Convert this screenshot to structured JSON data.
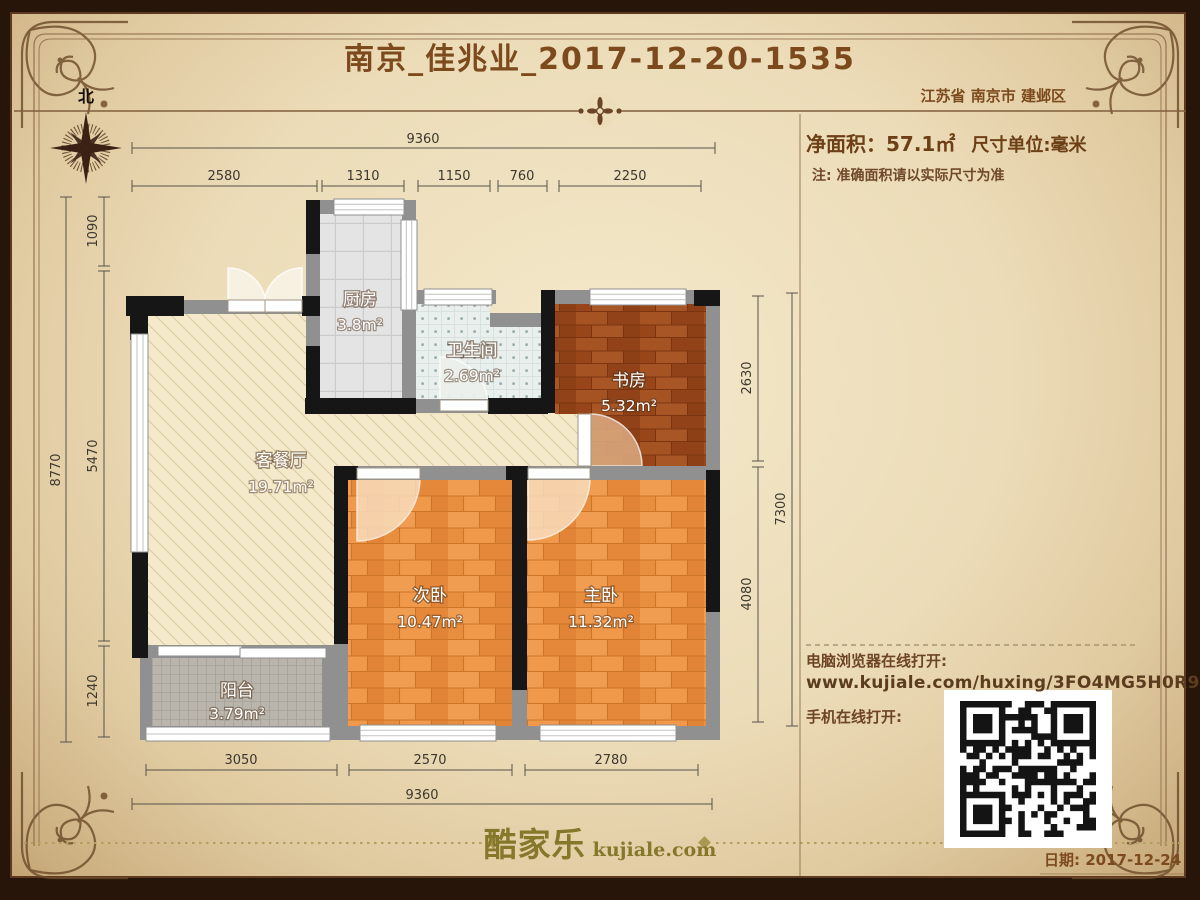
{
  "header": {
    "title": "南京_佳兆业_2017-12-20-1535",
    "location": "江苏省 南京市 建邺区",
    "north_label": "北"
  },
  "summary": {
    "net_area_label": "净面积：57.1㎡",
    "unit_label": "尺寸单位:毫米",
    "note": "注: 准确面积请以实际尺寸为准"
  },
  "share": {
    "pc_label": "电脑浏览器在线打开:",
    "url": "www.kujiale.com/huxing/3FO4MG5H0R9C",
    "mobile_label": "手机在线打开:"
  },
  "footer": {
    "logo_cn": "酷家乐",
    "logo_en": "kujiale.com",
    "date": "日期: 2017-12-24"
  },
  "floorplan": {
    "rooms": {
      "kitchen": {
        "name": "厨房",
        "area": "3.8m²"
      },
      "bathroom": {
        "name": "卫生间",
        "area": "2.69m²"
      },
      "study": {
        "name": "书房",
        "area": "5.32m²"
      },
      "living": {
        "name": "客餐厅",
        "area": "19.71m²"
      },
      "bedroom2": {
        "name": "次卧",
        "area": "10.47m²"
      },
      "master": {
        "name": "主卧",
        "area": "11.32m²"
      },
      "balcony": {
        "name": "阳台",
        "area": "3.79m²"
      }
    },
    "dimensions": {
      "top_total": "9360",
      "top_segments": [
        "2580",
        "1310",
        "1150",
        "760",
        "2250"
      ],
      "left_total": "8770",
      "left_segments": [
        "1090",
        "5470",
        "1240"
      ],
      "right_total": "7300",
      "right_segments": [
        "2630",
        "4080"
      ],
      "bottom_total": "9360",
      "bottom_segments": [
        "3050",
        "2570",
        "2780"
      ]
    }
  },
  "colors": {
    "frame": "#271509",
    "accent_brown": "#7c4a1d",
    "logo_olive": "#85782b",
    "wall_gray": "#909090",
    "wall_black": "#161616",
    "wood_orange": "#eb9344",
    "wood_dark": "#9b4a1e",
    "living_cream": "#f4eacb"
  }
}
